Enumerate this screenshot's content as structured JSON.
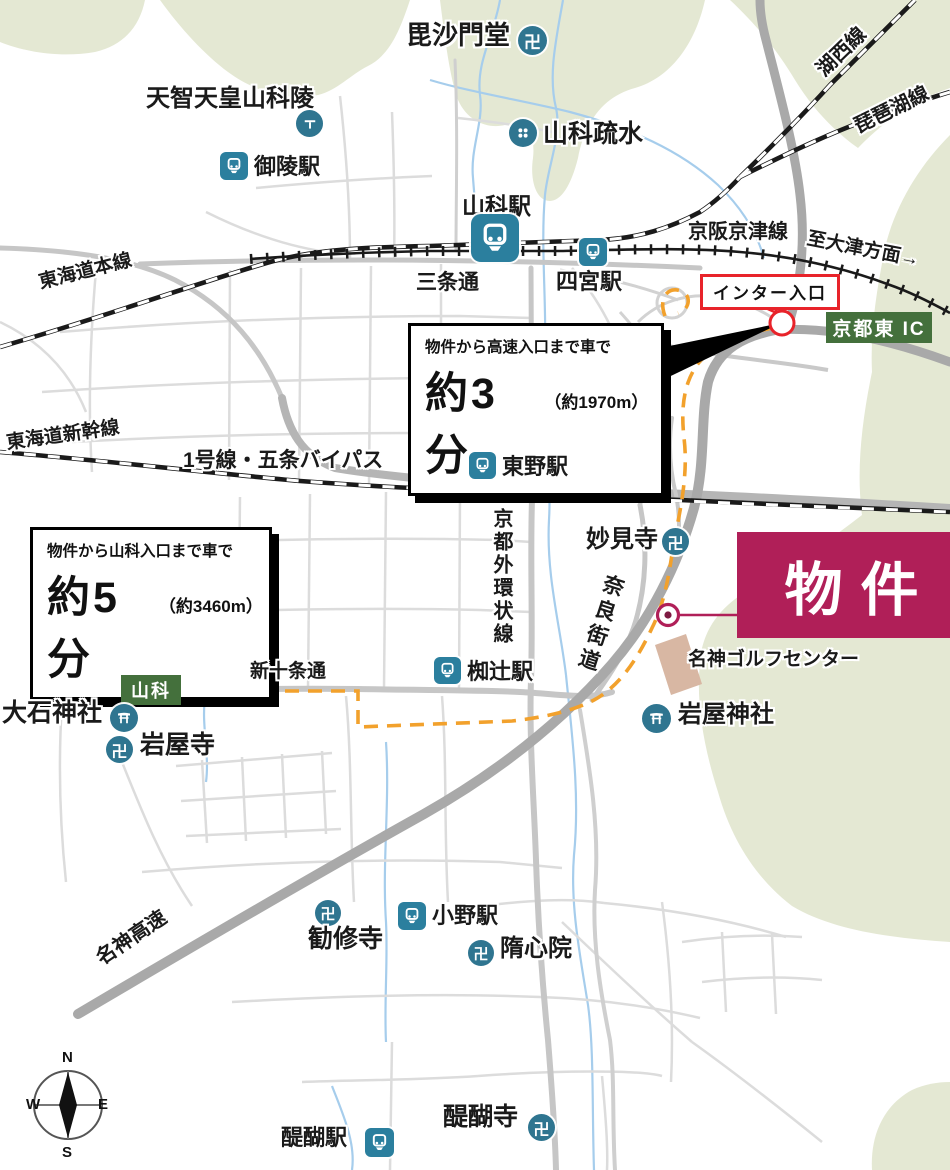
{
  "labels": {
    "bishamondo": "毘沙門堂",
    "yamashina_sosui": "山科疏水",
    "tenji_tomb": "天智天皇山科陵",
    "misasagi_sta": "御陵駅",
    "yamashina_sta": "山科駅",
    "shinomiya_sta": "四宮駅",
    "keihan_keishin_line": "京阪京津線",
    "to_otsu": "至大津方面→",
    "kosei_line": "湖西線",
    "biwako_line": "琵琶湖線",
    "tokaido_main_line": "東海道本線",
    "sanjo_dori": "三条通",
    "tokaido_shinkansen": "東海道新幹線",
    "route1_gojo_bypass": "1号線・五条バイパス",
    "higashino_sta": "東野駅",
    "myokenji": "妙見寺",
    "kyoto_gaikan": "京都外環状線",
    "nara_kaido": "奈良街道",
    "meishin_golf": "名神ゴルフセンター",
    "shinjujo_dori": "新十条通",
    "nagitsuji_sta": "椥辻駅",
    "oishi_shrine": "大石神社",
    "iwayaji": "岩屋寺",
    "iwaya_shrine": "岩屋神社",
    "kanshuji": "勧修寺",
    "ono_sta": "小野駅",
    "zuishinin": "隋心院",
    "meishin_kosoku": "名神高速",
    "daigo_sta": "醍醐駅",
    "daigoji": "醍醐寺"
  },
  "property": {
    "label": "物件"
  },
  "inter": {
    "label": "インター入口"
  },
  "badges": {
    "kyoto_higashi_ic": "京都東 IC",
    "yamashina": "山科"
  },
  "callouts": {
    "highway": {
      "desc": "物件から高速入口まで車で",
      "time": "約3分",
      "dist": "（約1970m）"
    },
    "yamashina": {
      "desc": "物件から山科入口まで車で",
      "time": "約5分",
      "dist": "（約3460m）"
    }
  },
  "compass": {
    "n": "N",
    "e": "E",
    "s": "S",
    "w": "W"
  },
  "icons": {
    "manji": "卍"
  },
  "colors": {
    "station_teal": "#2b7f9e",
    "poi_teal": "#2f7590",
    "property_crimson": "#b01f58",
    "badge_green": "#44703c",
    "route_orange": "#f2a12c",
    "alert_red": "#e8232a",
    "terrain_green": "#e4e8d3",
    "river_blue": "#a6cdec",
    "building_tan": "#d8b7a3"
  }
}
